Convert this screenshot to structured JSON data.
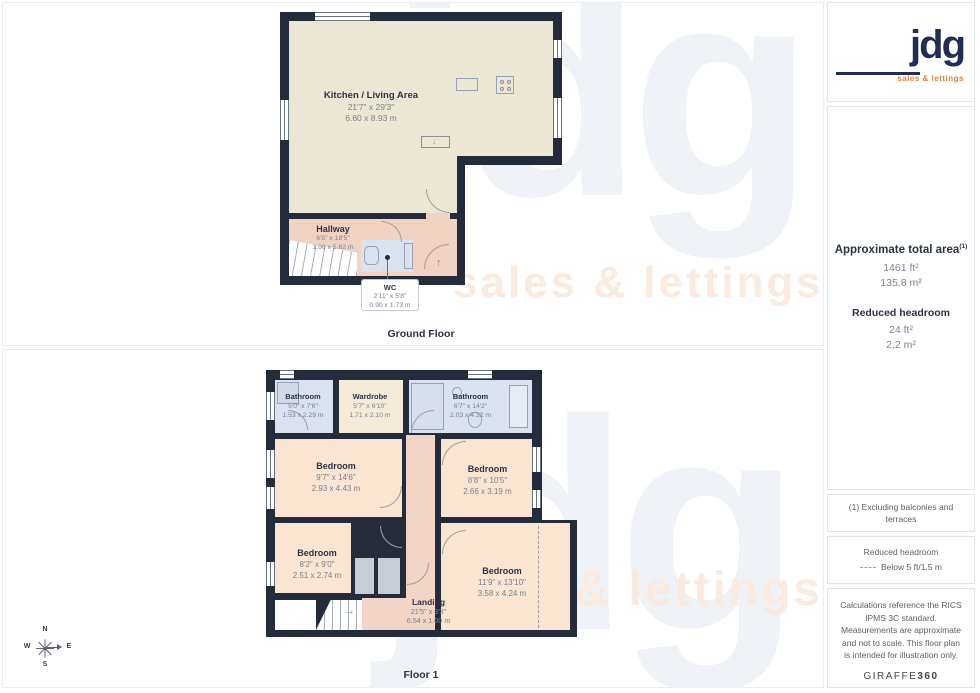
{
  "theme": {
    "wall_navy": "#242c3c",
    "brand_navy": "#222d56",
    "brand_orange": "#e0813f",
    "kitchen_cream": "#ece6d4",
    "hall_pink": "#f2d2c3",
    "bedroom_peach": "#f9e5d1",
    "bathroom_blue": "#dbe2ef",
    "wardrobe_cream": "#f3ead8",
    "closet_gray": "#c8ccd4"
  },
  "logo": {
    "text": "jdg",
    "tagline": "sales & lettings"
  },
  "watermark": {
    "text": "jdg",
    "tagline": "sales & lettings"
  },
  "icons": {
    "up_arrow": "↑",
    "right_arrow": "→",
    "down_arrow": "↓"
  },
  "compass": {
    "n": "N",
    "e": "E",
    "s": "S",
    "w": "W"
  },
  "ground_floor": {
    "label": "Ground Floor",
    "rooms": {
      "kitchen": {
        "name": "Kitchen / Living Area",
        "imperial": "21'7\" x 29'3\"",
        "metric": "6.60 x 8.93 m"
      },
      "hallway": {
        "name": "Hallway",
        "imperial": "6'5\" x 18'5\"",
        "metric": "1.96 x 5.62 m"
      },
      "wc": {
        "name": "WC",
        "imperial": "2'11\" x 5'8\"",
        "metric": "0.90 x 1.73 m"
      }
    }
  },
  "floor1": {
    "label": "Floor 1",
    "rooms": {
      "bathroom_left": {
        "name": "Bathroom",
        "imperial": "5'0\" x 7'6\"",
        "metric": "1.53 x 2.29 m"
      },
      "wardrobe": {
        "name": "Wardrobe",
        "imperial": "5'7\" x 6'10\"",
        "metric": "1.71 x 2.10 m"
      },
      "bathroom_right": {
        "name": "Bathroom",
        "imperial": "6'7\" x 14'2\"",
        "metric": "2.03 x 4.32 m"
      },
      "bedroom_mid_left": {
        "name": "Bedroom",
        "imperial": "9'7\" x 14'6\"",
        "metric": "2.93 x 4.43 m"
      },
      "bedroom_mid_right": {
        "name": "Bedroom",
        "imperial": "8'8\" x 10'5\"",
        "metric": "2.66 x 3.19 m"
      },
      "bedroom_bottom_left": {
        "name": "Bedroom",
        "imperial": "8'2\" x 9'0\"",
        "metric": "2.51 x 2.74 m"
      },
      "bedroom_bottom_right": {
        "name": "Bedroom",
        "imperial": "11'9\" x 13'10\"",
        "metric": "3.58 x 4.24 m"
      },
      "landing": {
        "name": "Landing",
        "imperial": "21'5\" x 3'3\"",
        "metric": "6.54 x 1.00 m"
      }
    }
  },
  "sidebar": {
    "area": {
      "title": "Approximate total area",
      "footnote_mark": "(1)",
      "total_ft": "1461 ft²",
      "total_m": "135.8 m²",
      "reduced_title": "Reduced headroom",
      "reduced_ft": "24 ft²",
      "reduced_m": "2.2 m²"
    },
    "note_excluding": "(1) Excluding balconies and terraces",
    "legend": {
      "title": "Reduced headroom",
      "value": "Below 5 ft/1.5 m"
    },
    "disclaimer": "Calculations reference the RICS IPMS 3C standard. Measurements are approximate and not to scale. This floor plan is intended for illustration only.",
    "brand": {
      "name": "GIRAFFE",
      "suffix": "360"
    }
  }
}
